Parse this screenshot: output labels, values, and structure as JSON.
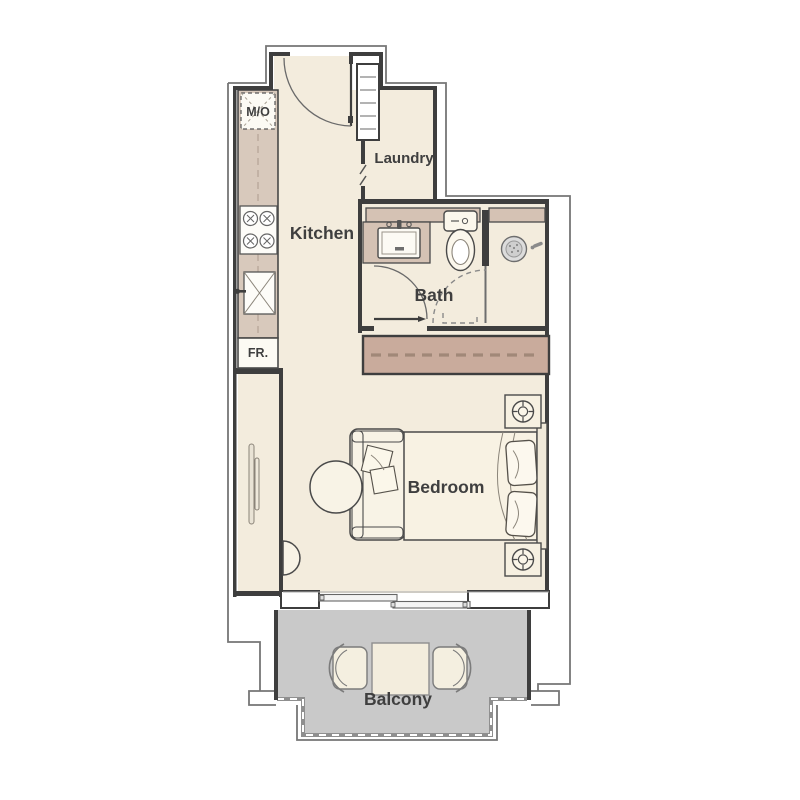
{
  "title": "Studio Apartment Floor Plan",
  "rooms": {
    "kitchen": {
      "label": "Kitchen"
    },
    "laundry": {
      "label": "Laundry"
    },
    "bath": {
      "label": "Bath"
    },
    "bedroom": {
      "label": "Bedroom"
    },
    "balcony": {
      "label": "Balcony"
    }
  },
  "appliances": {
    "microwave_oven": {
      "label": "M/O"
    },
    "fridge": {
      "label": "FR."
    }
  },
  "colors": {
    "floor": "#f3ecdd",
    "counter": "#d8c9bc",
    "wardrobe": "#c9ab9c",
    "vanity": "#d5c2b4",
    "balcony_floor": "#c9c9c9",
    "wall": "#3e3e3e",
    "outline": "#767676",
    "text": "#3f3f3f",
    "fixture_fill": "#fbf7ec"
  }
}
